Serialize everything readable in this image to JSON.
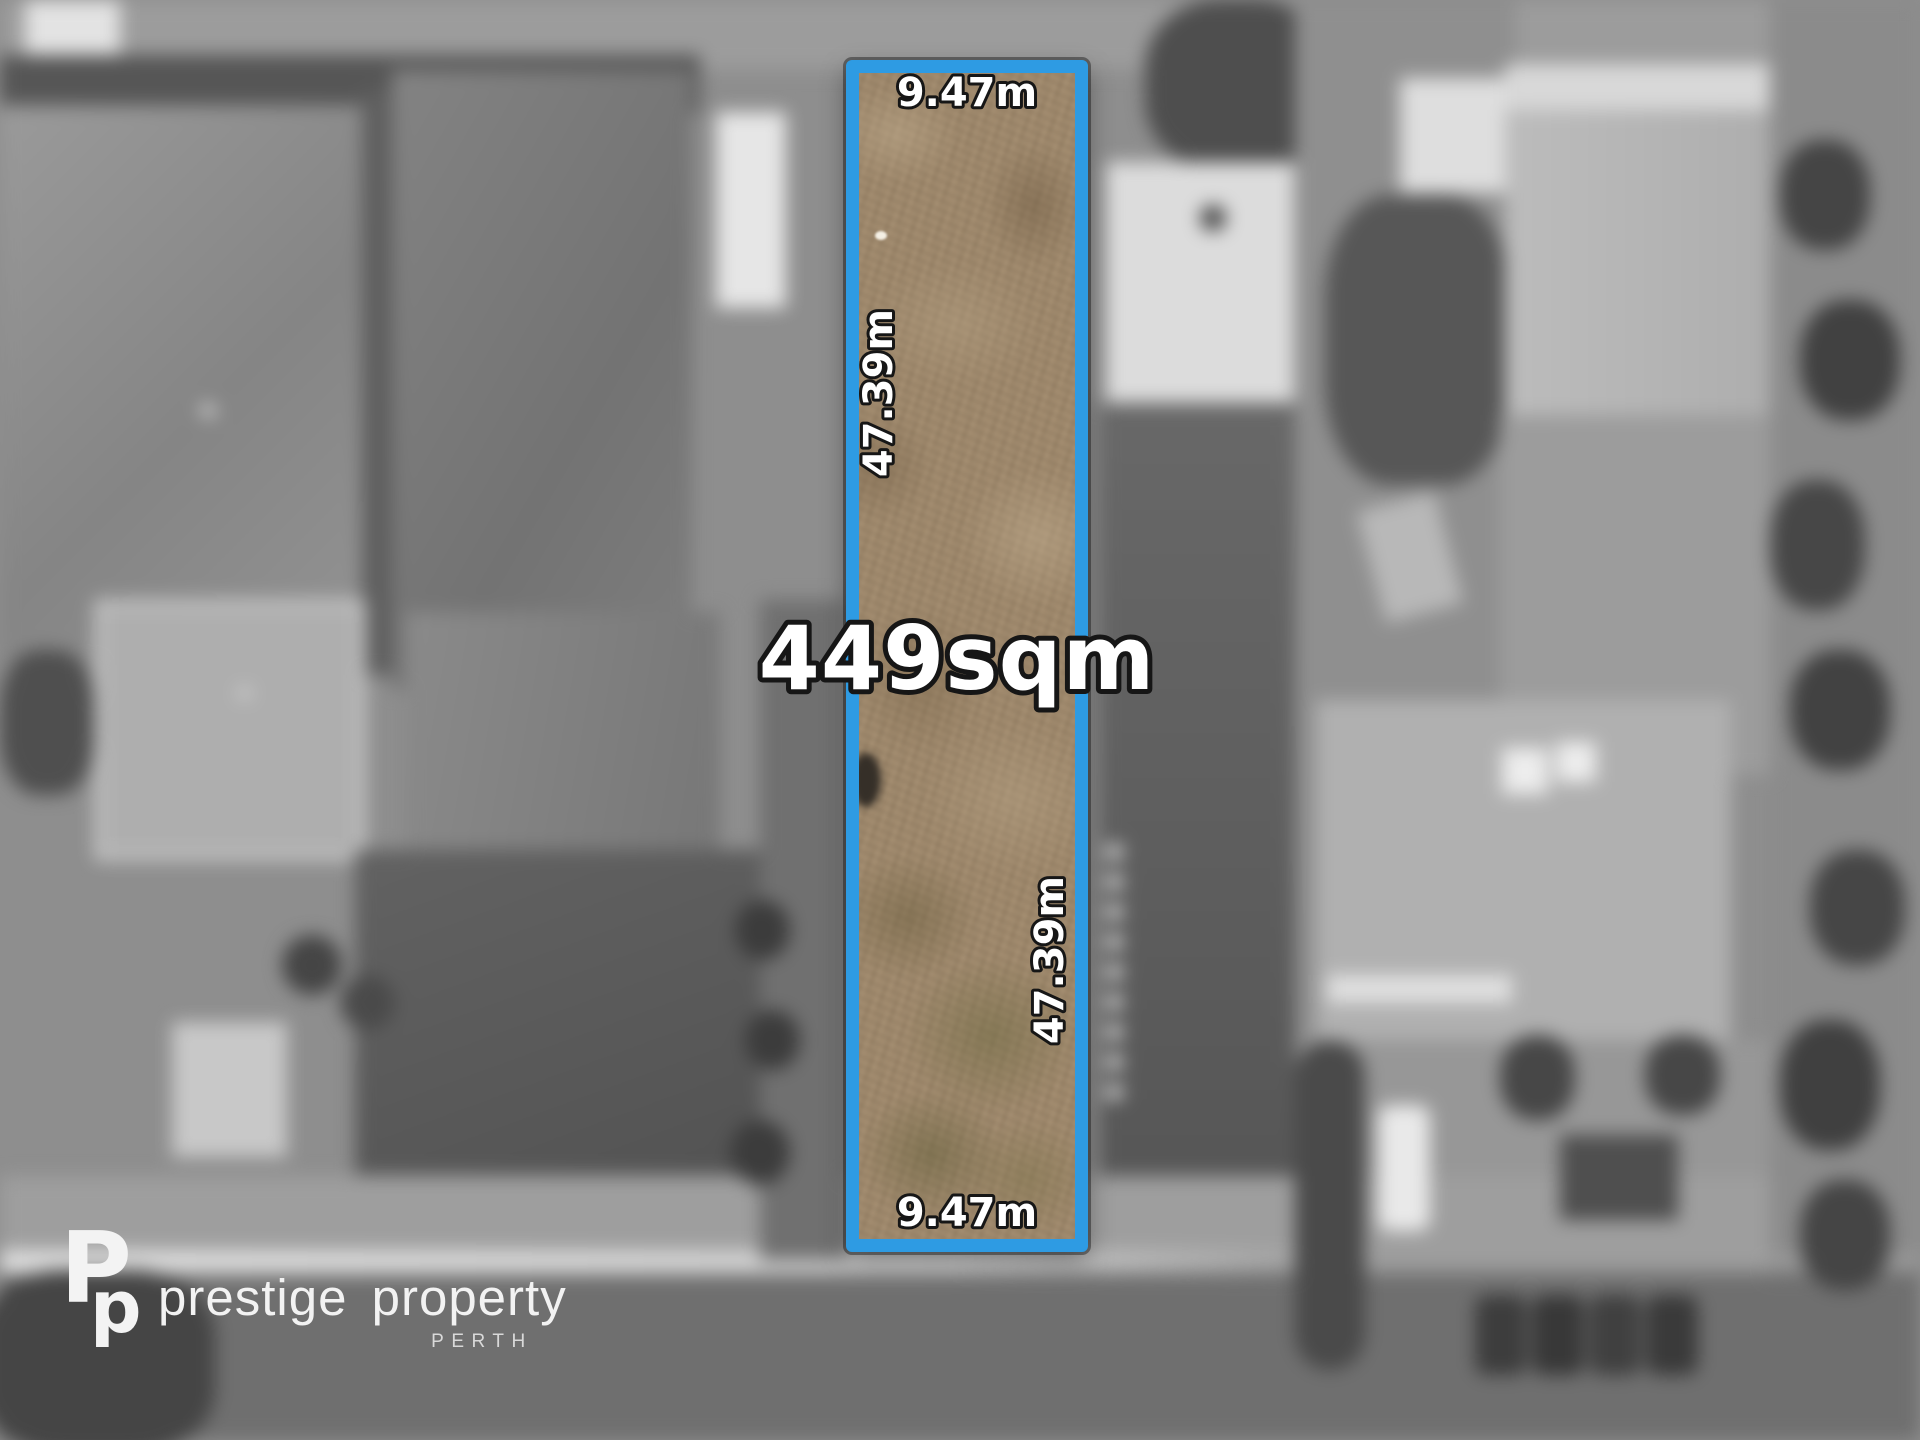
{
  "overlay": {
    "area_label": "449sqm",
    "top_frontage": "9.47m",
    "bottom_frontage": "9.47m",
    "left_depth": "47.39m",
    "right_depth": "47.39m",
    "boundary_color": "#2E9BE3",
    "label_fill_color": "#ffffff",
    "label_outline_color": "#161616"
  },
  "watermark": {
    "brand": "prestige property",
    "location": "PERTH",
    "monogram": [
      "P",
      "p"
    ]
  }
}
